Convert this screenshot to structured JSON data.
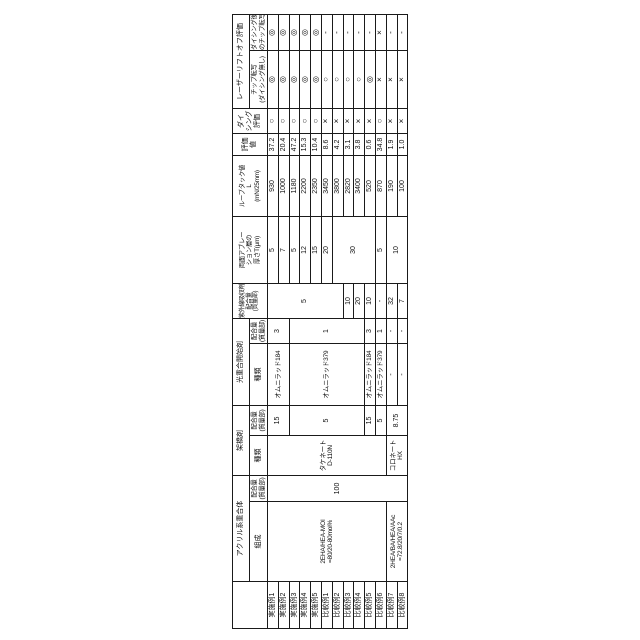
{
  "table": {
    "row_labels": [
      "実施例1",
      "実施例2",
      "実施例3",
      "実施例4",
      "実施例5",
      "比較例1",
      "比較例2",
      "比較例3",
      "比較例4",
      "比較例5",
      "比較例6",
      "比較例7",
      "比較例8"
    ],
    "headers": {
      "polymer_group": "アクリル系重合体",
      "composition": "組成",
      "amount_l1": "配合量",
      "amount_l2": "(質量部)",
      "kind": "種類",
      "crosslinker_group": "架橋剤",
      "initiator_group": "光重合開始剤",
      "uv_group": "紫外線吸収剤",
      "ablation_l1": "両面アブレー",
      "ablation_l2": "ション層の",
      "ablation_l3": "厚さT(μm)",
      "looptack_l1": "ループタック値",
      "looptack_l2": "L",
      "looptack_l3": "(mN/25mm)",
      "eval_l1": "評価",
      "eval_l2": "値",
      "dicing_l1": "ダイ",
      "dicing_l2": "シング",
      "dicing_l3": "評価",
      "laser_group": "レーザーリフトオフ評価",
      "chip1_l1": "チップ転写",
      "chip1_l2": "(ダイシング無し)",
      "chip2_l1": "ダイシング後",
      "chip2_l2": "のチップ転写"
    },
    "polymer": {
      "comp1_l1": "2EHA/HEA-MOI",
      "comp1_l2": "=80/20-80mol%",
      "comp2_l1": "2HEA/BA/HEA/AAc",
      "comp2_l2": "=72.8/20/7/0.2",
      "amount": "100"
    },
    "crosslinker": {
      "kind1_l1": "タケネート",
      "kind1_l2": "D-110N",
      "kind2_l1": "コロネート",
      "kind2_l2": "HX",
      "amounts": [
        "15",
        "5",
        "15",
        "5",
        "8.75"
      ]
    },
    "initiator": {
      "kinds": [
        "オムニラッド184",
        "オムニラッド379",
        "オムニラッド184",
        "オムニラッド379",
        "-",
        "-"
      ],
      "amounts": [
        "3",
        "1",
        "3",
        "1",
        "-",
        "-"
      ]
    },
    "uv_amounts": [
      "5",
      "10",
      "20",
      "10",
      "-",
      "32",
      "7"
    ],
    "ablation_thickness": [
      "5",
      "7",
      "5",
      "12",
      "15",
      "20",
      "30",
      "5",
      "10"
    ],
    "looptack": [
      "930",
      "1000",
      "1180",
      "2200",
      "2350",
      "3450",
      "3800",
      "2820",
      "3400",
      "520",
      "870",
      "190",
      "100"
    ],
    "eval_values": [
      "37.2",
      "20.4",
      "47.2",
      "15.3",
      "10.4",
      "8.6",
      "4.2",
      "3.1",
      "3.8",
      "0.6",
      "34.8",
      "1.9",
      "1.0"
    ],
    "dicing_eval": [
      "○",
      "○",
      "○",
      "○",
      "○",
      "×",
      "×",
      "×",
      "×",
      "×",
      "○",
      "×",
      "×"
    ],
    "chip_transfer_no_dicing": [
      "◎",
      "◎",
      "◎",
      "◎",
      "◎",
      "○",
      "○",
      "○",
      "○",
      "◎",
      "×",
      "×",
      "×"
    ],
    "chip_transfer_after_dicing": [
      "◎",
      "◎",
      "◎",
      "◎",
      "◎",
      "-",
      "-",
      "-",
      "-",
      "-",
      "×",
      "-",
      "-"
    ]
  }
}
